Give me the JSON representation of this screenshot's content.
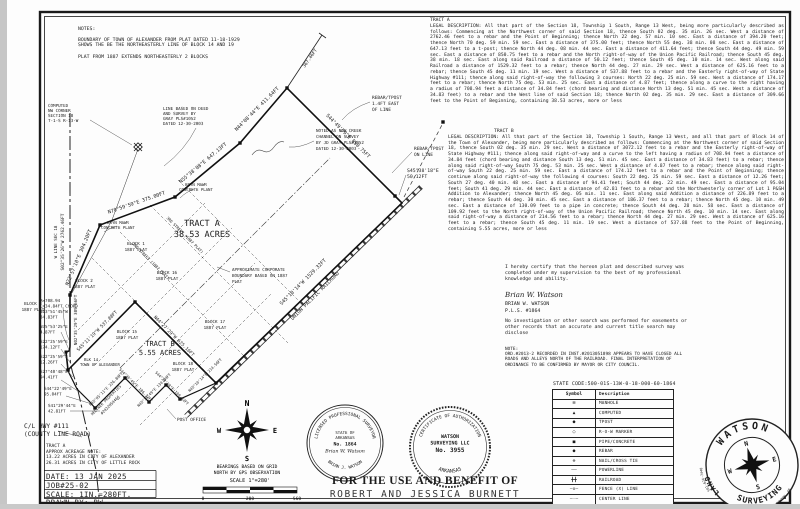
{
  "notes_block": {
    "title": "NOTES:",
    "body": "BOUNDARY OF TOWN OF ALEXANDER FROM PLAT DATED 11-18-1929\nSHOWS THE BE THE NORTHEASTERLY LINE OF BLOCK 14 AND 19\n\nPLAT FROM 1887 EXTENDS NORTHEASTERLY 2 BLOCKS"
  },
  "legal": {
    "tract_a_title": "TRACT A",
    "tract_a": "LEGAL DESCRIPTION: All that part of the Section 18, Township 1 South, Range 13 West, being more particularly described as follows: Commencing at the Northwest corner of said Section 18, thence South 02 deg. 35 min. 26 sec. West a distance of 2762.46 feet to a rebar and the Point of Beginning; thence North 22 deg. 57 min. 10 sec. East a distance of 394.20 feet; thence North 70 deg. 59 min. 59 sec. East a distance of 375.00 feet; thence North 55 deg. 38 min. 08 sec. East a distance of 647.13 feet to a t-post; thence North 44 deg. 08 min. 44 sec. East a distance of 411.64 feet; thence South 44 deg. 49 min. 59 sec. East a distance of 850.75 feet to a rebar and the North right-of-way of the Union Pacific Railroad; thence South 45 deg. 38 min. 18 sec. East along said Railroad a distance of 50.12 feet; thence South 45 deg. 10 min. 14 sec. West along said Railroad a distance of 1529.32 feet to a rebar; thence North 44 deg. 27 min. 29 sec. West a distance of 625.16 feet to a rebar; thence South 45 deg. 11 min. 19 sec. West a distance of 537.88 feet to a rebar and the Easterly right-of-way of State Highway #111; thence along said right-of-way the following 3 courses: North 22 deg. 25 min. 59 sec. West a distance of 174.17 feet to a rebar; thence North 75 deg. 53 min. 25 sec. East a distance of 4.87 feet; thence along a curve to the right having a radius of 708.94 feet a distance of 34.84 feet (chord bearing and distance North 13 deg. 51 min. 45 sec. West a distance of 34.83 feet) to a rebar and the West line of said Section 18; thence North 02 deg. 35 min. 29 sec. East a distance of 309.66 feet to the Point of Beginning, containing 38.53 acres, more or less",
    "tract_b_title": "TRACT B",
    "tract_b": "LEGAL DESCRIPTION: All that part of the Section 18, Township 1 South, Range 13 West, and all that part of Block 14 of the Town of Alexander, being more particularly described as follows: Commencing at the Northwest corner of said Section 18, thence South 02 deg. 35 min. 29 sec. West a distance of 3072.12 feet to a rebar and the Easterly right-of-way of State Highway #111; thence along said right-of-way and a curve to the left having a radius of 708.94 feet a distance of 34.84 feet (chord bearing and distance South 13 deg. 51 min. 45 sec. East a distance of 34.83 feet) to a rebar; thence along said right-of-way South 75 deg. 53 min. 25 sec. West a distance of 4.87 feet to a rebar; thence along said right-of-way South 22 deg. 25 min. 59 sec. East a distance of 174.12 feet to a rebar and the Point of Beginning; thence continue along said right-of-way the following 4 courses: South 22 deg. 25 min. 59 sec. East a distance of 12.26 feet; South 27 deg. 40 min. 48 sec. East a distance of 94.41 feet; South 44 deg. 22 min. 49 sec. East a distance of 95.04 feet; South 41 deg. 29 min. 44 sec. East a distance of 42.81 feet to a rebar and the Northwesterly corner of Lot 1 P&SH Addition to Alexander; thence North 45 deg. 05 min. 11 sec. East along said Addition a distance of 226.89 feet to a rebar; thence South 44 deg. 30 min. 45 sec. East a distance of 186.37 feet to a rebar; thence North 45 deg. 10 min. 49 sec. East a distance of 130.09 feet to a pipe in concrete; thence South 44 deg. 28 min. 58 sec. East a distance of 109.92 feet to the North right-of-way of the Union Pacific Railroad; thence North 45 deg. 10 min. 14 sec. East along said right-of-way a distance of 214.56 feet to a rebar; thence North 44 deg. 27 min. 29 sec. West a distance of 625.16 feet to a rebar; thence South 45 deg. 11 min. 19 sec. West a distance of 537.88 feet to the Point of Beginning, containing 5.55 acres, more or less"
  },
  "certification": {
    "text": "I hereby certify that the hereon plat and described survey was completed under my supervision to the best of my professional knowledge and ability.",
    "signature_script": "Brian W. Watson",
    "name": "BRIAN W. WATSON",
    "license": "P.L.S. #1864",
    "disclaimer": "No investigation or other search was performed for easements or other records that an accurate and current title search may disclose",
    "note_title": "NOTE:",
    "note": "ORD.#2013-2 RECORDED IN INST.#2013051898 APPEARS TO HAVE CLOSED ALL ROADS AND ALLEYS NORTH OF THE RAILROAD. FINAL INTERPRETATION OF ORDINANCE TO BE CONFIRMED BY MAYOR OR CITY COUNCIL."
  },
  "state_code": "STATE CODE:500-01S-13W-0-18-000-60-1864",
  "legend": {
    "headers": [
      "Symbol",
      "Description"
    ],
    "rows": [
      {
        "glyph": "⊠",
        "desc": "MANHOLE"
      },
      {
        "glyph": "▲",
        "desc": "COMPUTED"
      },
      {
        "glyph": "●",
        "desc": "TPOST"
      },
      {
        "glyph": "○",
        "desc": "R-O-W MARKER"
      },
      {
        "glyph": "■",
        "desc": "PIPE/CONCRETE"
      },
      {
        "glyph": "●",
        "desc": "REBAR"
      },
      {
        "glyph": "⊕",
        "desc": "NAIL/CROSS TIE"
      },
      {
        "glyph": "——",
        "desc": "POWERLINE"
      },
      {
        "glyph": "╋╋",
        "desc": "RAILROAD"
      },
      {
        "glyph": "—x—",
        "desc": "FENCE (X) LINE"
      },
      {
        "glyph": "—·—",
        "desc": "CENTER LINE"
      },
      {
        "glyph": "———",
        "desc": "PROPERTY LINE"
      }
    ]
  },
  "title_block": {
    "tract_note": "TRACT A\nAPPROX ACREAGE NOTE:\n13.22 ACRES IN CITY OF ALEXANDER\n26.31 ACRES IN CITY OF LITTLE ROCK",
    "date": "DATE: 13 JAN 2025",
    "job": "JOB#25-02",
    "scale": "SCALE: 1IN.=280FT.",
    "drawn": "DRAWN BY: BW"
  },
  "benefit": {
    "line1": "FOR THE USE AND BENEFIT OF",
    "line2": "ROBERT AND JESSICA BURNETT"
  },
  "scale_info": {
    "bearings_1": "BEARINGS BASED ON GRID",
    "bearings_2": "NORTH BY GPS OBSERVATION",
    "scale_text": "SCALE  1\"=280'",
    "tick_0": "0",
    "tick_1": "280",
    "tick_2": "560"
  },
  "compass": {
    "n": "N",
    "s": "S",
    "e": "E",
    "w": "W"
  },
  "seals": {
    "pls": {
      "arc_top": "LICENSED PROFESSIONAL SURVEYOR",
      "arc_bottom": "BRIAN J. WATSON",
      "line1": "STATE OF",
      "line2": "ARKANSAS",
      "line3": "No. 1864",
      "signature": "Brian W. Watson"
    },
    "coa": {
      "arc_top": "CERTIFICATE OF AUTHORIZATION",
      "arc_bottom": "ARKANSAS",
      "line1": "WATSON",
      "line2": "SURVEYING LLC",
      "line3": "No. 3955"
    }
  },
  "logo": {
    "arc_top": "WATSON",
    "arc_left": "LAND",
    "arc_bottom": "SURVEYING",
    "phone": "501-626-7440",
    "address": "10709 HWY. 5 BENTON, AR",
    "n": "N",
    "e": "E",
    "s": "S",
    "w": "W"
  },
  "drawing": {
    "labels": [
      "TRACT A",
      "38.53 ACRES",
      "TRACT B",
      "5.55 ACRES",
      "S45°10'14\"W 1529.32FT",
      "UNION PACIFIC RAILROAD",
      "S44°49'59\"E 850.75FT",
      "N44°08'44\"E 411.64FT",
      "N55°38'08\"E 647.13FT",
      "N70°59'59\"E 375.00FT",
      "N22°57'10\"E 394.20FT",
      "367.46FT",
      "S45°38'18\"E",
      "50.12FT",
      "REBAR/TPOST",
      "ON LINE",
      "REBAR/TPOST",
      "1.4FT EAST",
      "OF LINE",
      "NOTED AS NEW CREEK",
      "CHANNEL ON SURVEY",
      "BY JD GRAY PLS#1052",
      "DATED 12-30-2003",
      "LINE BASED ON DEED",
      "AND SURVEY BY",
      "GRAY PLS#1052",
      "DATED 12-30-2003",
      "COMPUTED",
      "NW CORNER",
      "SECTION 18",
      "T-1-S R-13-W",
      "S02°35'26\"W 2762.46FT",
      "W LINE SEC 18",
      "N02°35'29\"E 309.66FT",
      "R=708.94",
      "L=34.84FT CHORD",
      "N13°51'45\"W",
      "34.83FT",
      "N75°53'25\"E",
      "4.87FT",
      "S22°25'59\"E",
      "174.12FT",
      "S22°25'59\"E",
      "12.26FT",
      "S27°40'48\"E",
      "94.41FT",
      "S44°22'49\"E",
      "95.04FT",
      "S41°29'44\"E",
      "42.81FT",
      "C/L HWY #111",
      "(COUNTY LINE ROAD)",
      "N44°27'29\"W 625.16FT",
      "S45°11'19\"W 537.88FT",
      "N45°05'11\"E 226.89FT",
      "S44°30'45\"E 186.37FT",
      "N45°10'49\"E 130.09FT",
      "S44°28'58\"E 109.92FT",
      "POST OFFICE",
      "HELTNER PROPERTIES",
      "#2022059466",
      "BLK 14",
      "TOWN OF ALEXANDER",
      "BLOCK 1",
      "1887 PLAT",
      "BLOCK 2",
      "1887 PLAT",
      "BLOCK 3",
      "1887 PLAT",
      "BLOCK 15",
      "1887 PLAT",
      "BLOCK 16",
      "1887 PLAT",
      "BLOCK 17",
      "1887 PLAT",
      "BLOCK 18",
      "1887 PLAT",
      "2ND STREET (1887 PLAT)",
      "3RD STREET (1887 PLAT)",
      "APPROXIMATE CORPORATE",
      "BOUNDARY BASED ON 1887",
      "PLAT",
      "N45°10'14\"E 214.56FT",
      "BRYN MAWR",
      "CONCRETE PLANT",
      "BRYN MAWR",
      "CONCRETE PLANT"
    ]
  }
}
